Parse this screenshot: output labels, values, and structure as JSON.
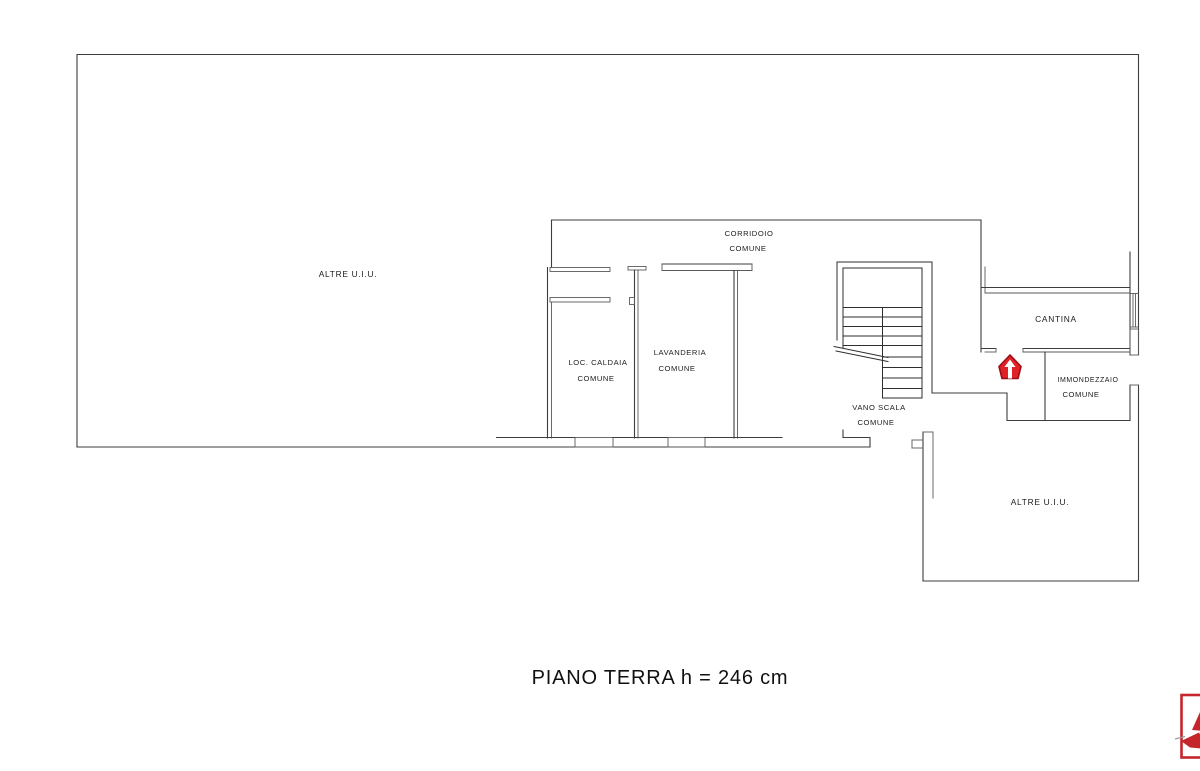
{
  "plan": {
    "title": "PIANO TERRA h = 246 cm",
    "rooms": {
      "altre_uiu_left": {
        "label": "ALTRE U.I.U."
      },
      "corridoio": {
        "label": "CORRIDOIO",
        "sublabel": "COMUNE"
      },
      "loc_caldaia": {
        "label": "LOC. CALDAIA",
        "sublabel": "COMUNE"
      },
      "lavanderia": {
        "label": "LAVANDERIA",
        "sublabel": "COMUNE"
      },
      "vano_scala": {
        "label": "VANO SCALA",
        "sublabel": "COMUNE"
      },
      "cantina": {
        "label": "CANTINA"
      },
      "immondezzaio": {
        "label": "IMMONDEZZAIO",
        "sublabel": "COMUNE"
      },
      "altre_uiu_bottom": {
        "label": "ALTRE U.I.U."
      }
    },
    "icons": {
      "entrance_arrow": "red house-shaped up-arrow marking the CANTINA entrance",
      "logo": "red agency logo, clipped at page edge"
    },
    "colors": {
      "wall": "#3d3d3d",
      "arrow_red": "#e02128",
      "arrow_red_dark": "#9e0f14",
      "logo_red": "#c5262c",
      "white": "#ffffff"
    }
  }
}
